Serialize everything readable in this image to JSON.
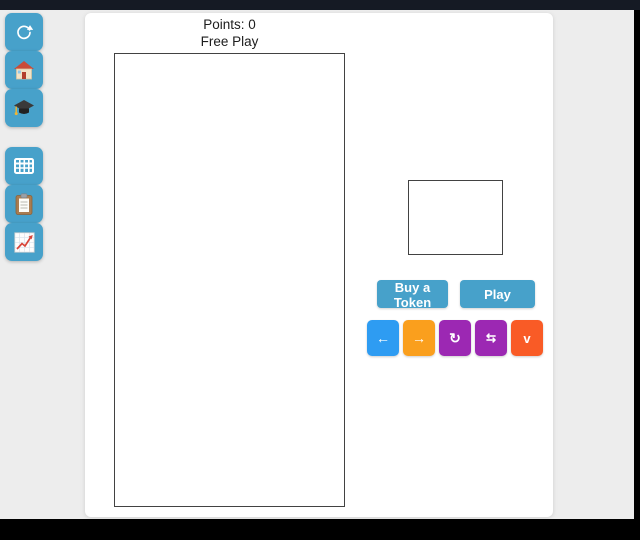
{
  "header": {
    "points_label": "Points: 0",
    "mode_label": "Free Play"
  },
  "sidebar": {
    "button_color": "#47a1ca",
    "groups": [
      {
        "items": [
          {
            "icon": "refresh-icon"
          },
          {
            "icon": "house-icon"
          },
          {
            "icon": "graduation-cap-icon"
          }
        ]
      },
      {
        "items": [
          {
            "icon": "grid-icon"
          },
          {
            "icon": "clipboard-icon"
          },
          {
            "icon": "chart-icon"
          }
        ]
      }
    ]
  },
  "actions": {
    "buy_token_label": "Buy a Token",
    "play_label": "Play"
  },
  "controls": [
    {
      "name": "move-left",
      "glyph": "←",
      "color": "#2e9cf2"
    },
    {
      "name": "move-right",
      "glyph": "→",
      "color": "#fa9f1d"
    },
    {
      "name": "rotate",
      "glyph": "↻",
      "color": "#9c28b3"
    },
    {
      "name": "flip",
      "glyph": "⇆",
      "color": "#9c28b3"
    },
    {
      "name": "drop",
      "glyph": "v",
      "color": "#f95b26"
    }
  ],
  "colors": {
    "topbar": "#151a24",
    "page_background": "#ededed",
    "panel": "#ffffff",
    "board_border": "#424242",
    "teal_button": "#47a1ca"
  }
}
